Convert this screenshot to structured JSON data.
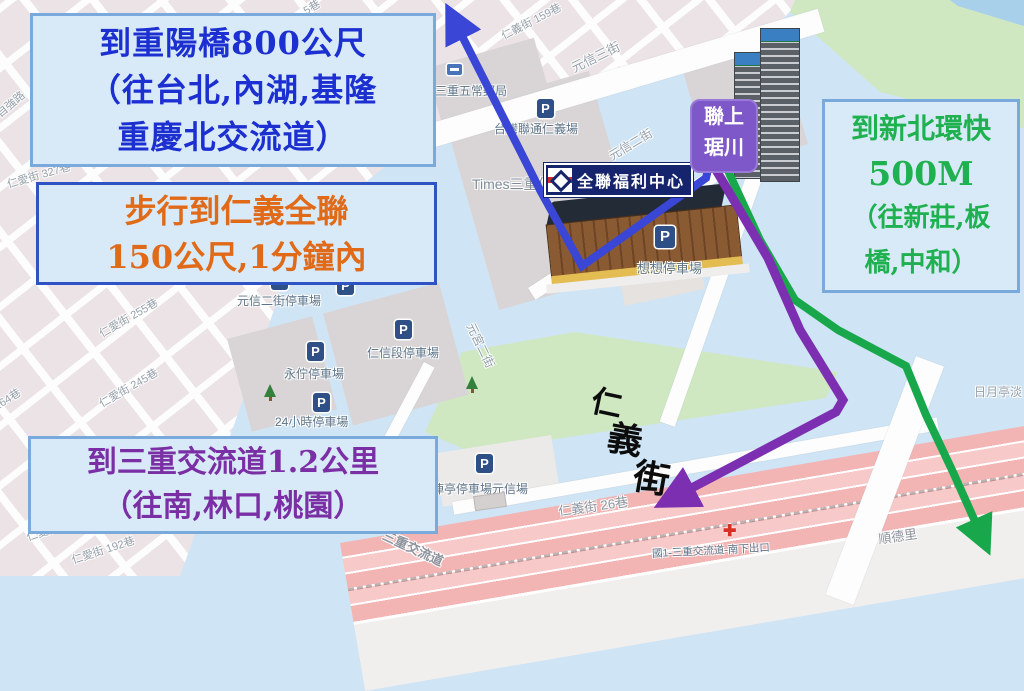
{
  "annotations": {
    "chongyang": {
      "line1": "到重陽橋800公尺",
      "line2": "（往台北,內湖,基隆",
      "line3": "重慶北交流道）",
      "color": "#1c2fd0"
    },
    "walk": {
      "line1": "步行到仁義全聯",
      "line2": "150公尺,1分鐘內",
      "color": "#e06a18"
    },
    "huankuai": {
      "line1": "到新北環快",
      "line2": "500M",
      "line3": "（往新莊,板",
      "line4": "橋,中和）",
      "color": "#1fb150"
    },
    "sanchong": {
      "line1": "到三重交流道1.2公里",
      "line2": "（往南,林口,桃園）",
      "color": "#7a2fa5"
    }
  },
  "landmarks": {
    "lianshang_line1": "聯上",
    "lianshang_line2": "琚川",
    "pxmart_sign": "全聯福利中心",
    "renyi_char1": "仁",
    "renyi_char2": "義",
    "renyi_char3": "街"
  },
  "streets": [
    {
      "text": "自強路"
    },
    {
      "text": "仁愛街 327巷"
    },
    {
      "text": "仁愛街 255巷"
    },
    {
      "text": "仁愛街 245巷"
    },
    {
      "text": "仁愛街 264巷"
    },
    {
      "text": "仁愛街 192巷"
    },
    {
      "text": "仁愛街"
    },
    {
      "text": "仁義街 159巷"
    },
    {
      "text": "5巷"
    },
    {
      "text": "元信三街"
    },
    {
      "text": "元信二街"
    },
    {
      "text": "元宮二街"
    },
    {
      "text": "仁義街 26巷"
    },
    {
      "text": "順德里"
    },
    {
      "text": "日月亭淡"
    },
    {
      "text": "三重交流道"
    },
    {
      "text": "國1-三重交流道-南下出口"
    }
  ],
  "pois": [
    {
      "text": "三重五常郵局"
    },
    {
      "text": "台灣聯通仁義場"
    },
    {
      "text": "Times三重仁"
    },
    {
      "text": "想想停車場"
    },
    {
      "text": "元信二街停車場"
    },
    {
      "text": "永佇停車場"
    },
    {
      "text": "仁信段停車場"
    },
    {
      "text": "24小時停車場"
    },
    {
      "text": "俥亭停車場元信場"
    }
  ],
  "icons": {
    "parking": "P"
  },
  "routes": {
    "blue": {
      "color": "#3a46d6",
      "meaning": "to Chongyang bridge"
    },
    "purple": {
      "color": "#7c2fb0",
      "meaning": "to Sanchong interchange"
    },
    "green": {
      "color": "#18a84b",
      "meaning": "to New Taipei expressway"
    }
  },
  "colors": {
    "map_bg": "#cfe4f4",
    "city_blocks": "#ece3e7",
    "parcel": "#d9d5d6",
    "park": "#cfe8c2",
    "river": "#a8d0ea",
    "highway": "#f3b4b4",
    "note_bg": "#d8eaf8",
    "note_border": "#7aa9dc",
    "note_border_dark": "#3053c4",
    "pxmart_navy": "#16246e",
    "pxmart_red": "#d5281e",
    "lianshang_purple": "#7e57c8",
    "p_icon": "#2f4f87",
    "exit_red": "#d93025"
  }
}
